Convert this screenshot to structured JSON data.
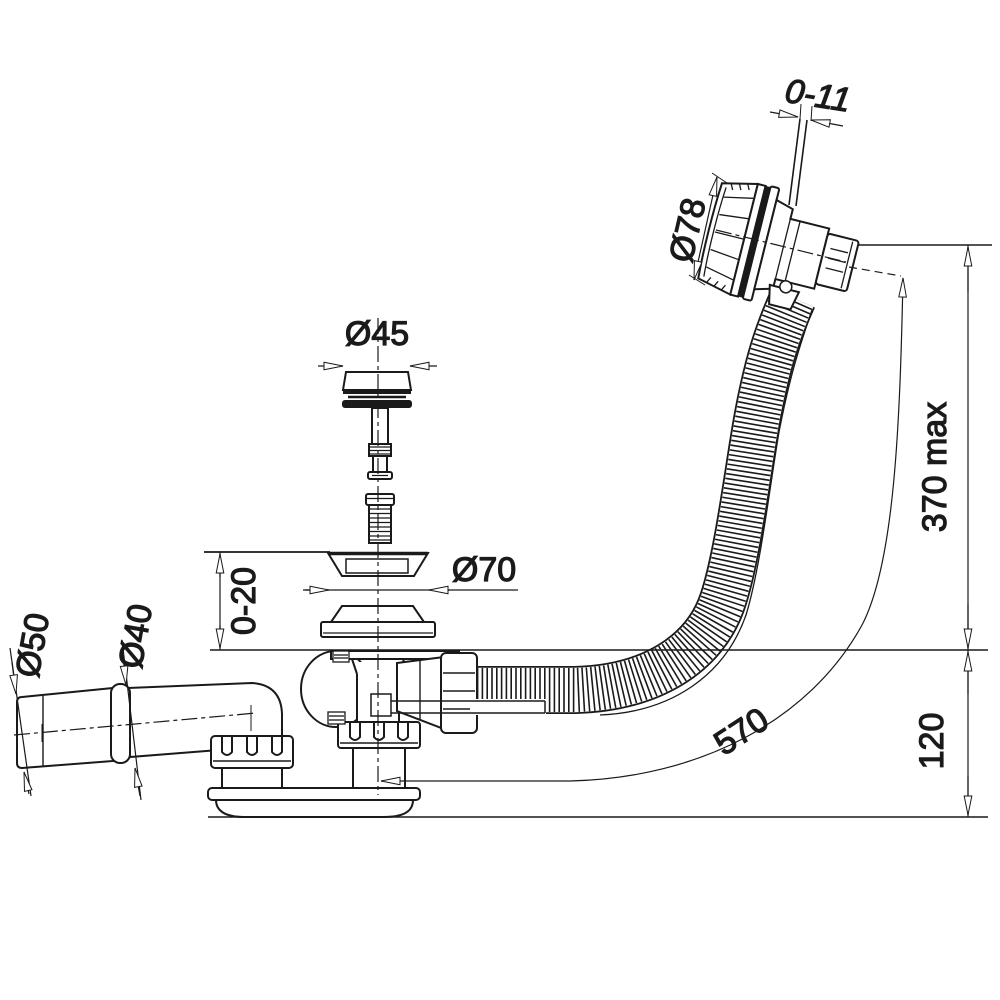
{
  "drawing": {
    "kind": "technical-line-drawing",
    "background": "#ffffff",
    "line_color": "#1a1a1a"
  },
  "dimensions": {
    "knob_travel": "0-11",
    "overflow_cap_diameter": "Ø78",
    "plug_diameter": "Ø45",
    "flange_diameter": "Ø70",
    "bath_panel_thickness": "0-20",
    "outlet_cone_diameter": "Ø50",
    "outlet_pipe_diameter": "Ø40",
    "max_overflow_height": "370 max",
    "trap_depth": "120",
    "hose_length": "570"
  }
}
